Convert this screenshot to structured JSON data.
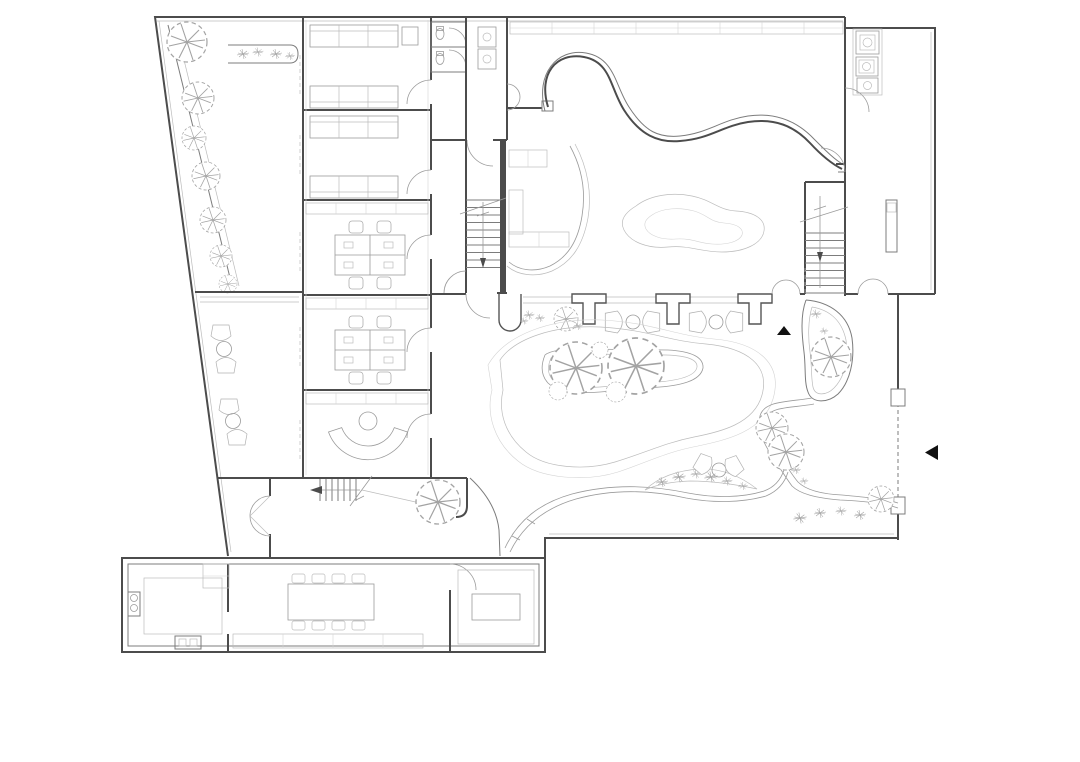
{
  "palette": {
    "background": "#ffffff",
    "wall": "#4c4c4c",
    "partition": "#7c7c7c",
    "furniture": "#9b9b9b",
    "light_detail": "#bcbcbc",
    "vegetation": "#a3a3a3",
    "marker": "#111111"
  },
  "markers": {
    "courtyard_entrance_arrow": {
      "icon": "triangle-up-icon",
      "color": "#111111"
    },
    "east_entrance_arrow": {
      "icon": "triangle-left-icon",
      "color": "#111111"
    }
  }
}
